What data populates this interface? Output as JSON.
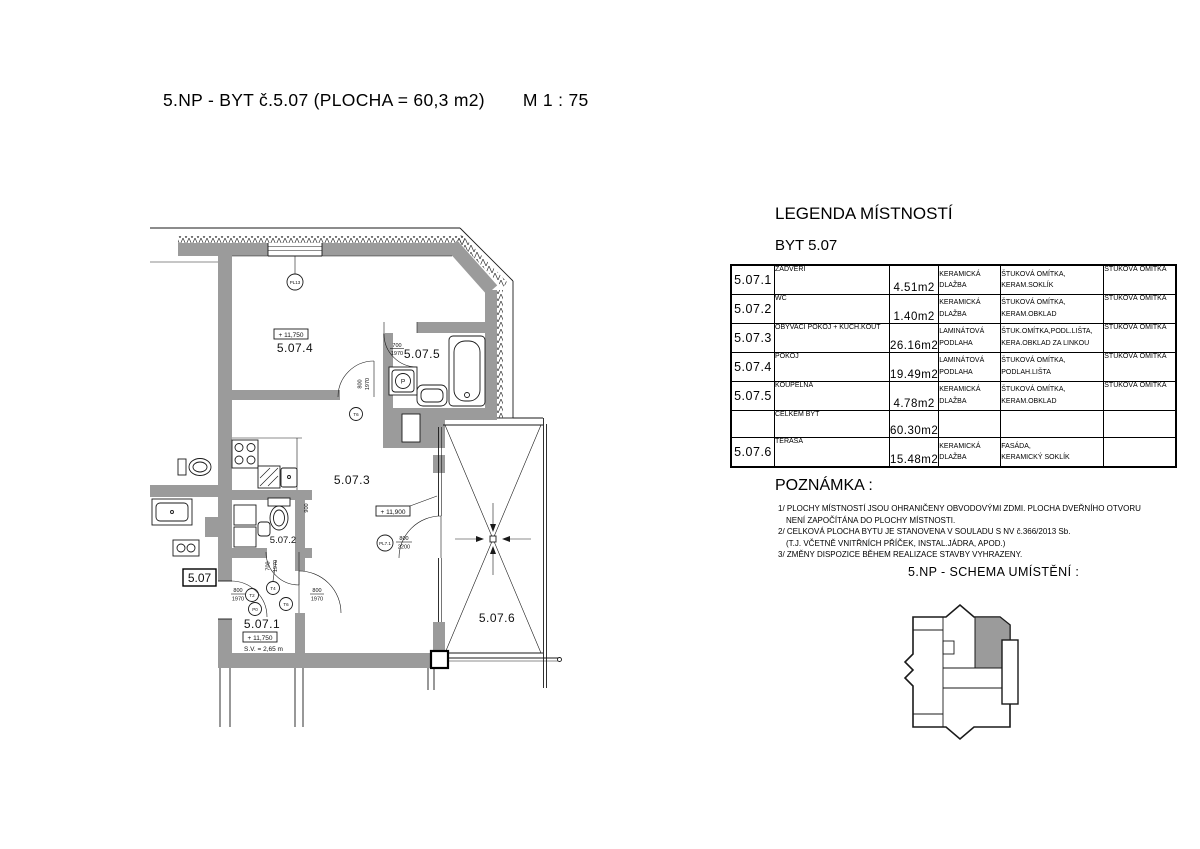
{
  "page": {
    "title": "5.NP - BYT č.5.07 (PLOCHA = 60,3 m2)",
    "scale": "M 1 : 75"
  },
  "legend": {
    "heading": "LEGENDA MÍSTNOSTÍ",
    "subheading": "BYT 5.07",
    "rows": [
      {
        "id": "5.07.1",
        "name": "ZÁDVEŘÍ",
        "area": "4.51m2",
        "floor": "KERAMICKÁ\nDLAŽBA",
        "walls": "ŠTUKOVÁ OMÍTKA,\nKERAM.SOKLÍK",
        "ceiling": "ŠTUKOVÁ OMÍTKA"
      },
      {
        "id": "5.07.2",
        "name": "WC",
        "area": "1.40m2",
        "floor": "KERAMICKÁ\nDLAŽBA",
        "walls": "ŠTUKOVÁ OMÍTKA,\nKERAM.OBKLAD",
        "ceiling": "ŠTUKOVÁ OMÍTKA"
      },
      {
        "id": "5.07.3",
        "name": "OBÝVACÍ POKOJ + KUCH.KOUT",
        "area": "26.16m2",
        "floor": "LAMINÁTOVÁ\nPODLAHA",
        "walls": "ŠTUK.OMÍTKA,PODL.LIŠTA,\nKERA.OBKLAD ZA LINKOU",
        "ceiling": "ŠTUKOVÁ OMÍTKA"
      },
      {
        "id": "5.07.4",
        "name": "POKOJ",
        "area": "19.49m2",
        "floor": "LAMINÁTOVÁ\nPODLAHA",
        "walls": "ŠTUKOVÁ OMÍTKA,\nPODLAH.LIŠTA",
        "ceiling": "ŠTUKOVÁ OMÍTKA"
      },
      {
        "id": "5.07.5",
        "name": "KOUPELNA",
        "area": "4.78m2",
        "floor": "KERAMICKÁ\nDLAŽBA",
        "walls": "ŠTUKOVÁ OMÍTKA,\nKERAM.OBKLAD",
        "ceiling": "ŠTUKOVÁ OMÍTKA"
      },
      {
        "id": "",
        "name": "CELKEM BYT",
        "area": "60.30m2",
        "floor": "",
        "walls": "",
        "ceiling": ""
      },
      {
        "id": "5.07.6",
        "name": "TERASA",
        "area": "15.48m2",
        "floor": "KERAMICKÁ\nDLAŽBA",
        "walls": "FASÁDA,\nKERAMICKÝ SOKLÍK",
        "ceiling": ""
      }
    ]
  },
  "notes": {
    "heading": "POZNÁMKA :",
    "lines": [
      "1/ PLOCHY MÍSTNOSTÍ JSOU OHRANIČENY OBVODOVÝMI ZDMI. PLOCHA DVEŘNÍHO OTVORU",
      "NENÍ ZAPOČÍTÁNA DO PLOCHY MÍSTNOSTI.",
      "2/ CELKOVÁ PLOCHA BYTU JE STANOVENA V SOULADU S NV č.366/2013 Sb.",
      "(T.J. VČETNĚ VNITŘNÍCH PŘÍČEK, INSTAL.JÁDRA, APOD.)",
      "3/ ZMĚNY DISPOZICE BĚHEM REALIZACE STAVBY VYHRAZENY."
    ]
  },
  "schema": {
    "heading": "5.NP - SCHEMA UMÍSTĚNÍ :"
  },
  "plan": {
    "apartment_tag": "5.07",
    "rooms": {
      "r1": "5.07.1",
      "r2": "5.07.2",
      "r3": "5.07.3",
      "r4": "5.07.4",
      "r5": "5.07.5",
      "r6": "5.07.6"
    },
    "levels": {
      "main": "+ 11,750",
      "terrace_door": "+ 11,900"
    },
    "ceiling_height": "S.V. = 2,65 m",
    "window_tag": "PL13",
    "terrace_door_tag": "PL7.1",
    "door_sizes": {
      "w700": "700",
      "w800": "800",
      "h1970": "1970",
      "h2200": "2200"
    },
    "dim_900": "900",
    "fixture_tags": {
      "t2": "T2",
      "t4": "T4",
      "t6": "T6",
      "p0": "P0",
      "washer": "P"
    },
    "colors": {
      "wall_fill": "#9b9b9b",
      "line": "#1a1a1a"
    }
  }
}
